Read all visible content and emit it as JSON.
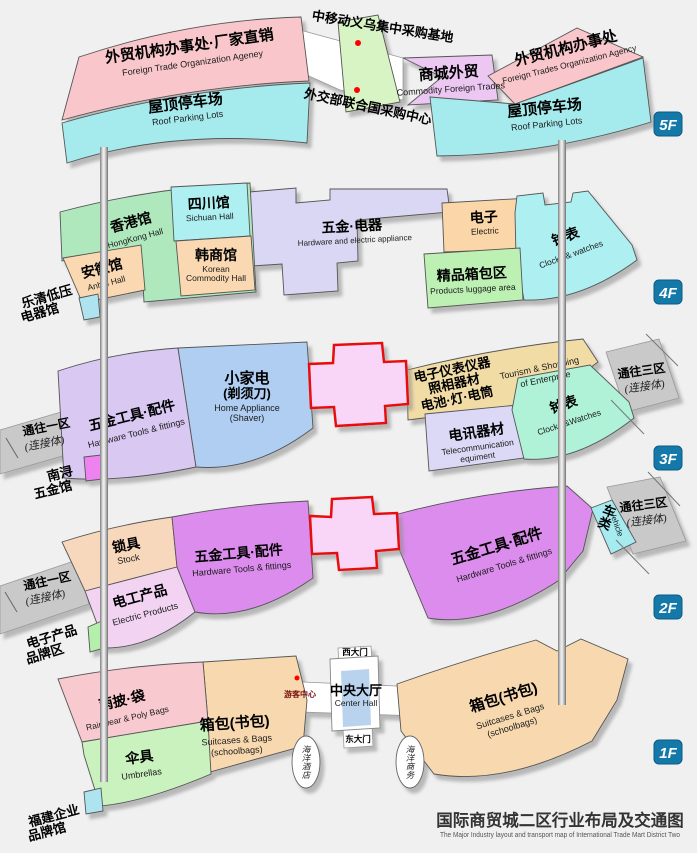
{
  "title": {
    "cn": "国际商贸城二区行业布局及交通图",
    "en": "The Major Industry layout and transport map of International Trade Mart District Two"
  },
  "colors": {
    "badge": "#1478A8",
    "cross_fill": "#F9D6F7",
    "cross_border": "#E8100C",
    "marker": "#FF0000"
  },
  "f5": {
    "badge": "5F",
    "office_left_cn": "外贸机构办事处·厂家直销",
    "office_left_en": "Foreign Trade Organization Ageney",
    "parking_left_cn": "屋顶停车场",
    "parking_left_en": "Roof Parking Lots",
    "mobile_base": "中移动义乌集中采购基地",
    "un_center": "外交部联合国采购中心",
    "commodity_cn": "商城外贸",
    "commodity_en": "Commodity Foreign Trades",
    "office_right_cn": "外贸机构办事处",
    "office_right_en": "Foreign Trades Organization Agency",
    "parking_right_cn": "屋顶停车场",
    "parking_right_en": "Roof Parking Lots"
  },
  "f4": {
    "badge": "4F",
    "hongkong_cn": "香港馆",
    "hongkong_en": "HongKong Hall",
    "sichuan_cn": "四川馆",
    "sichuan_en": "Sichuan Hall",
    "korean_cn": "韩商馆",
    "korean_en1": "Korean",
    "korean_en2": "Commodity Hall",
    "anhui_cn": "安徽馆",
    "anhui_en": "Anhui Hall",
    "yueqing_l1": "乐清低压",
    "yueqing_l2": "电器馆",
    "hardware_cn": "五金·电器",
    "hardware_en": "Hardware and electric appliance",
    "electric_cn": "电子",
    "electric_en": "Electric",
    "clocks_cn": "钟表",
    "clocks_en": "Clocks & watches",
    "luggage_cn": "精品箱包区",
    "luggage_en": "Products luggage area"
  },
  "f3": {
    "badge": "3F",
    "link1_cn": "通往一区",
    "link1_sub": "(连接体)",
    "tools_cn": "五金工具·配件",
    "tools_en": "Hardware Tools & fittings",
    "appliance_cn1": "小家电",
    "appliance_cn2": "(剃须刀)",
    "appliance_en1": "Home Appliance",
    "appliance_en2": "(Shaver)",
    "nanxun_l1": "南浔",
    "nanxun_l2": "五金馆",
    "instruments_cn1": "电子仪表仪器",
    "instruments_cn2": "照相器材",
    "instruments_cn3": "电池·灯·电筒",
    "tourism_en1": "Tourism & Shopping",
    "tourism_en2": "of Enterprise",
    "telecom_cn": "电讯器材",
    "telecom_en1": "Telecommunication",
    "telecom_en2": "equiment",
    "clocks_cn": "钟表",
    "clocks_en": "Clocks &Watches",
    "link3_cn": "通往三区",
    "link3_sub": "(连接体)"
  },
  "f2": {
    "badge": "2F",
    "link1_cn": "通往一区",
    "link1_sub": "(连接体)",
    "locks_cn": "锁具",
    "locks_en": "Stock",
    "electric_cn": "电工产品",
    "electric_en": "Electric Products",
    "tools_left_cn": "五金工具·配件",
    "tools_left_en": "Hardware Tools & fittings",
    "tools_right_cn": "五金工具·配件",
    "tools_right_en": "Hardware Tools & fittings",
    "vehicle_cn": "车类",
    "vehicle_en": "Vehicle",
    "brand_l1": "电子产品",
    "brand_l2": "品牌区",
    "link3_cn": "通往三区",
    "link3_sub": "(连接体)"
  },
  "f1": {
    "badge": "1F",
    "rainwear_cn": "雨披·袋",
    "rainwear_en": "Rainwear & Poly Bags",
    "umbrella_cn": "伞具",
    "umbrella_en": "Umbrellas",
    "bags_left_cn": "箱包(书包)",
    "bags_left_en1": "Suitcases & Bags",
    "bags_left_en2": "(schoolbags)",
    "bags_right_cn": "箱包(书包)",
    "bags_right_en1": "Suitcases & Bags",
    "bags_right_en2": "(schoolbags)",
    "visitor": "游客中心",
    "hall_cn": "中央大厅",
    "hall_en": "Center Hall",
    "west_gate": "西大门",
    "east_gate": "东大门",
    "hotel": "海洋酒店",
    "business": "海洋商务",
    "fujian_l1": "福建企业",
    "fujian_l2": "品牌馆"
  }
}
